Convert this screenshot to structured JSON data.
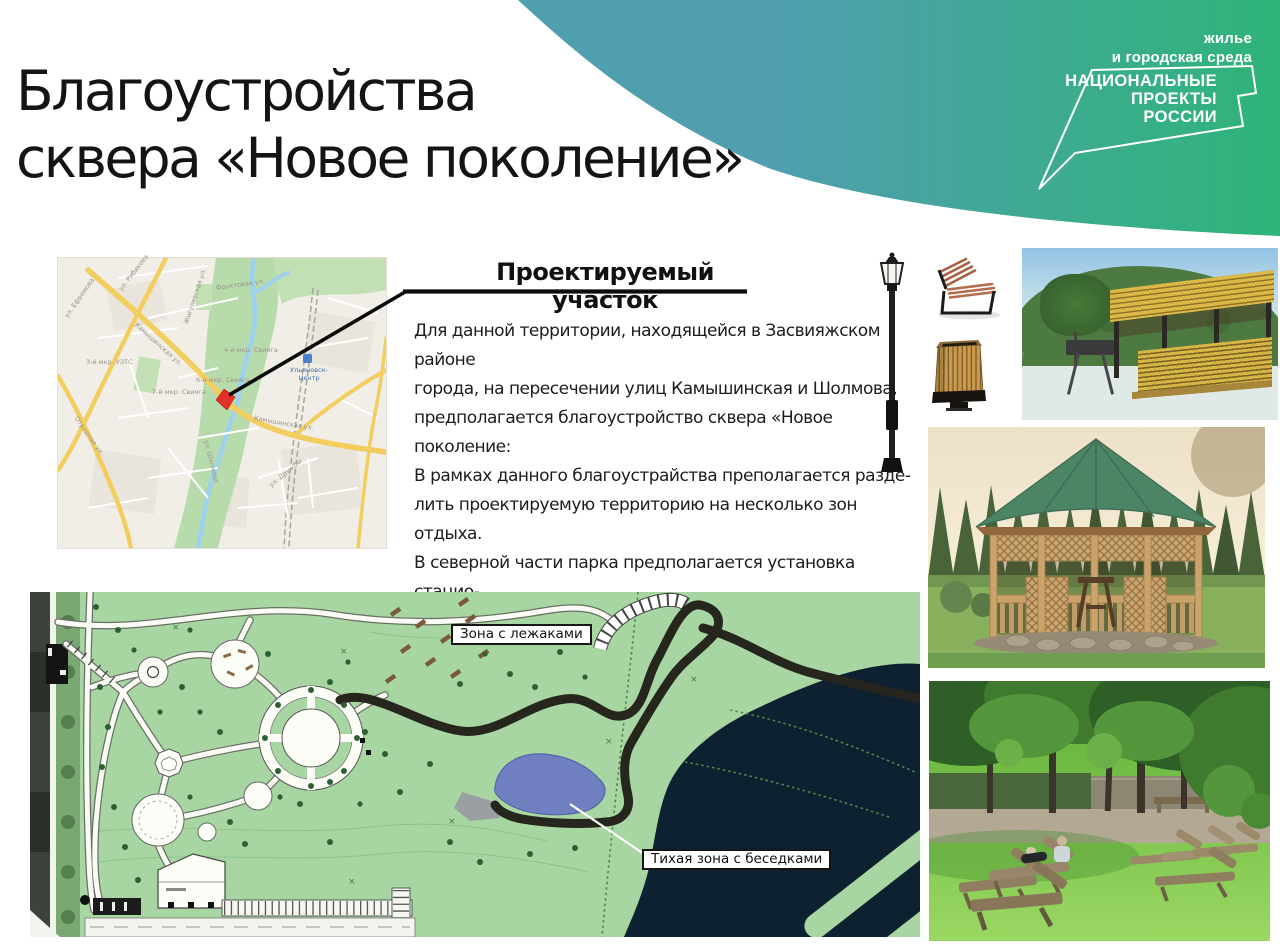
{
  "header": {
    "title": "Благоустройства\nсквера «Новое поколение»"
  },
  "brand": {
    "tagline": "жилье\nи городская среда",
    "logo": [
      "НАЦИОНАЛЬНЫЕ",
      "ПРОЕКТЫ",
      "РОССИИ"
    ],
    "gradient_start": "#4f9fae",
    "gradient_end": "#2eb478"
  },
  "project_section": {
    "heading": "Проектируемый участок",
    "body": "Для данной территории, находящейся в Засвияжском районе\nгорода, на пересечении улиц Камышинская и Шолмова,\nпредполагается благоустройство сквера «Новое поколение:\nВ рамках данного благоустрайства преполагается разде-\nлить проектируемую территорию на несколько зон отдыха.\nВ северной части парка предполагается установка стацио-\nнарных лежаков. а в южной части – оформление тихой зоны с\nбеседками."
  },
  "location_map": {
    "marker_color": "#e23128",
    "station_label": "Ульяновск-\nЦентр",
    "street_labels": [
      {
        "text": "ул. Рябикова"
      },
      {
        "text": "Камышинская ул."
      },
      {
        "text": "ул. Ефремова"
      },
      {
        "text": "Отрадная ул."
      },
      {
        "text": "ул. Шолмова"
      },
      {
        "text": "Жигулевская ул."
      },
      {
        "text": "Фруктовая ул."
      },
      {
        "text": "ул. Дружбы"
      },
      {
        "text": "3-й мкр. УЗТС"
      },
      {
        "text": "6-й мкр. Свияга"
      },
      {
        "text": "7-й мкр. Свияга"
      },
      {
        "text": "4-й мкр. Свияга"
      }
    ]
  },
  "site_plan": {
    "labels": {
      "loungers_zone": "Зона с лежаками",
      "quiet_zone": "Тихая зона с беседками"
    },
    "cross_mark": "×",
    "colors": {
      "ground": "#a8d6a3",
      "water_dark": "#0e2130",
      "pond": "#6f7fc0",
      "road": "#26261f"
    }
  },
  "icons": {
    "street_lamp": "street-lamp-icon",
    "bench": "bench-icon",
    "trash_bin": "trash-bin-icon"
  },
  "photos": {
    "pavilion": "wooden-pavilion-photo",
    "gazebo": "garden-gazebo-photo",
    "loungers": "park-loungers-photo"
  }
}
